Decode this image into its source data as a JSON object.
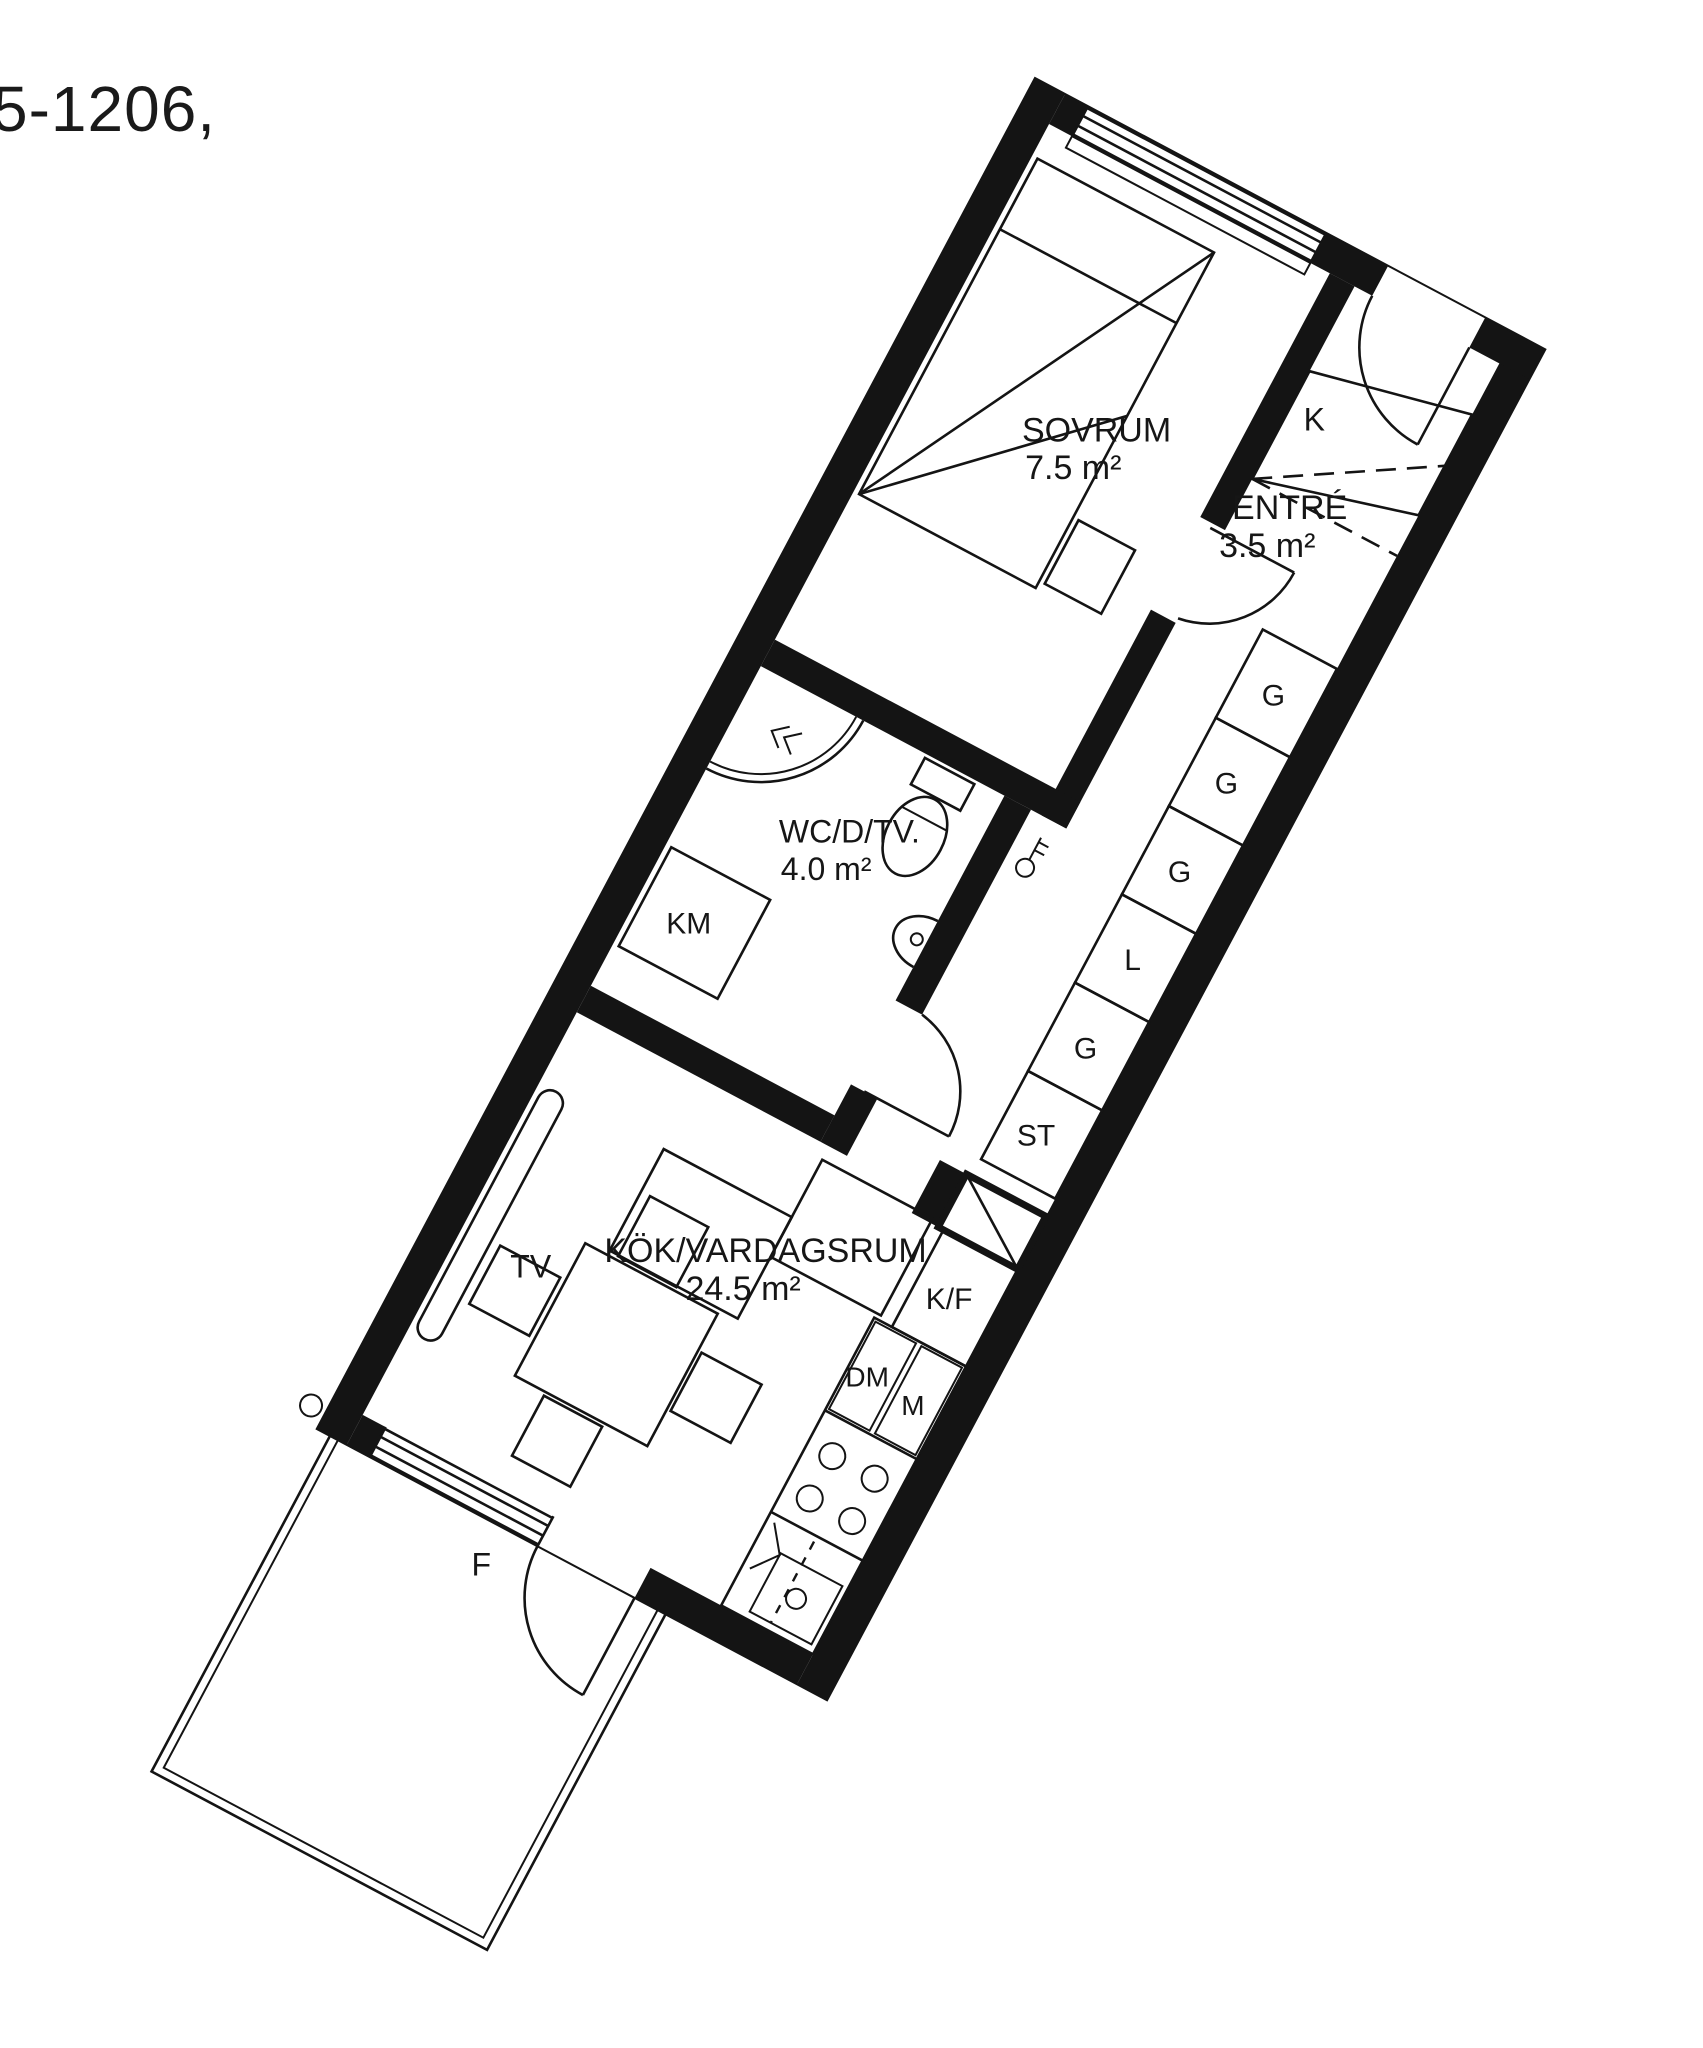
{
  "title": "5-1206,",
  "colors": {
    "ink": "#141414",
    "background": "#ffffff"
  },
  "plan": {
    "rooms": {
      "sovrum": {
        "name": "SOVRUM",
        "area": "7.5 m²"
      },
      "entre": {
        "name": "ENTRÉ",
        "area": "3.5 m²"
      },
      "wc": {
        "name": "WC/D/TV.",
        "area": "4.0 m²"
      },
      "kok": {
        "name": "KÖK/VARDAGSRUM",
        "area": "24.5 m²"
      }
    },
    "storage": {
      "k": "K",
      "g1": "G",
      "g2": "G",
      "g3": "G",
      "l": "L",
      "g4": "G",
      "st": "ST"
    },
    "kitchen": {
      "kf": "K/F",
      "dm": "DM",
      "m": "M"
    },
    "laundry": {
      "km": "KM"
    },
    "living": {
      "tv": "TV"
    },
    "facade": {
      "f": "F"
    },
    "icons": [
      "bed-icon",
      "nightstand-icon",
      "shower-icon",
      "toilet-icon",
      "washbasin-icon",
      "washing-machine-icon",
      "wardrobe-icon",
      "vent-shaft-icon",
      "fridge-freezer-icon",
      "dishwasher-icon",
      "stove-icon",
      "sink-icon",
      "sofa-icon",
      "tv-bench-icon",
      "dining-table-icon",
      "chair-icon",
      "balcony-icon",
      "door-swing-icon",
      "key-icon"
    ]
  }
}
